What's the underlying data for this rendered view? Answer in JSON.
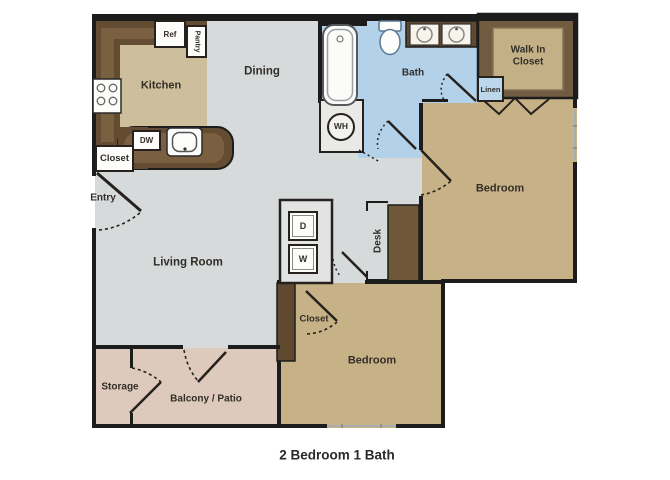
{
  "floor_plan": {
    "caption": "2 Bedroom 1 Bath",
    "rooms": {
      "kitchen": "Kitchen",
      "dining": "Dining",
      "living_room": "Living Room",
      "bath": "Bath",
      "walk_in_closet": "Walk In Closet",
      "bedroom_right": "Bedroom",
      "bedroom_bottom": "Bedroom",
      "storage": "Storage",
      "balcony": "Balcony / Patio",
      "entry": "Entry",
      "desk": "Desk",
      "entry_closet": "Closet",
      "bedroom_closet": "Closet",
      "linen": "Linen"
    },
    "appliances": {
      "refrigerator": "Ref",
      "pantry": "Pantry",
      "dishwasher": "DW",
      "dryer": "D",
      "washer": "W",
      "water_heater": "WH"
    },
    "colors": {
      "floor_gray": "#d6dadb",
      "bedroom_tan": "#c7b288",
      "kitchen_tan": "#cdbf9c",
      "bath_blue": "#b3d1e9",
      "balcony_pink": "#ddcabc",
      "counter_brown": "#634c32",
      "walkin_brown": "#715c41",
      "outline_black": "#1c1c1c"
    }
  }
}
